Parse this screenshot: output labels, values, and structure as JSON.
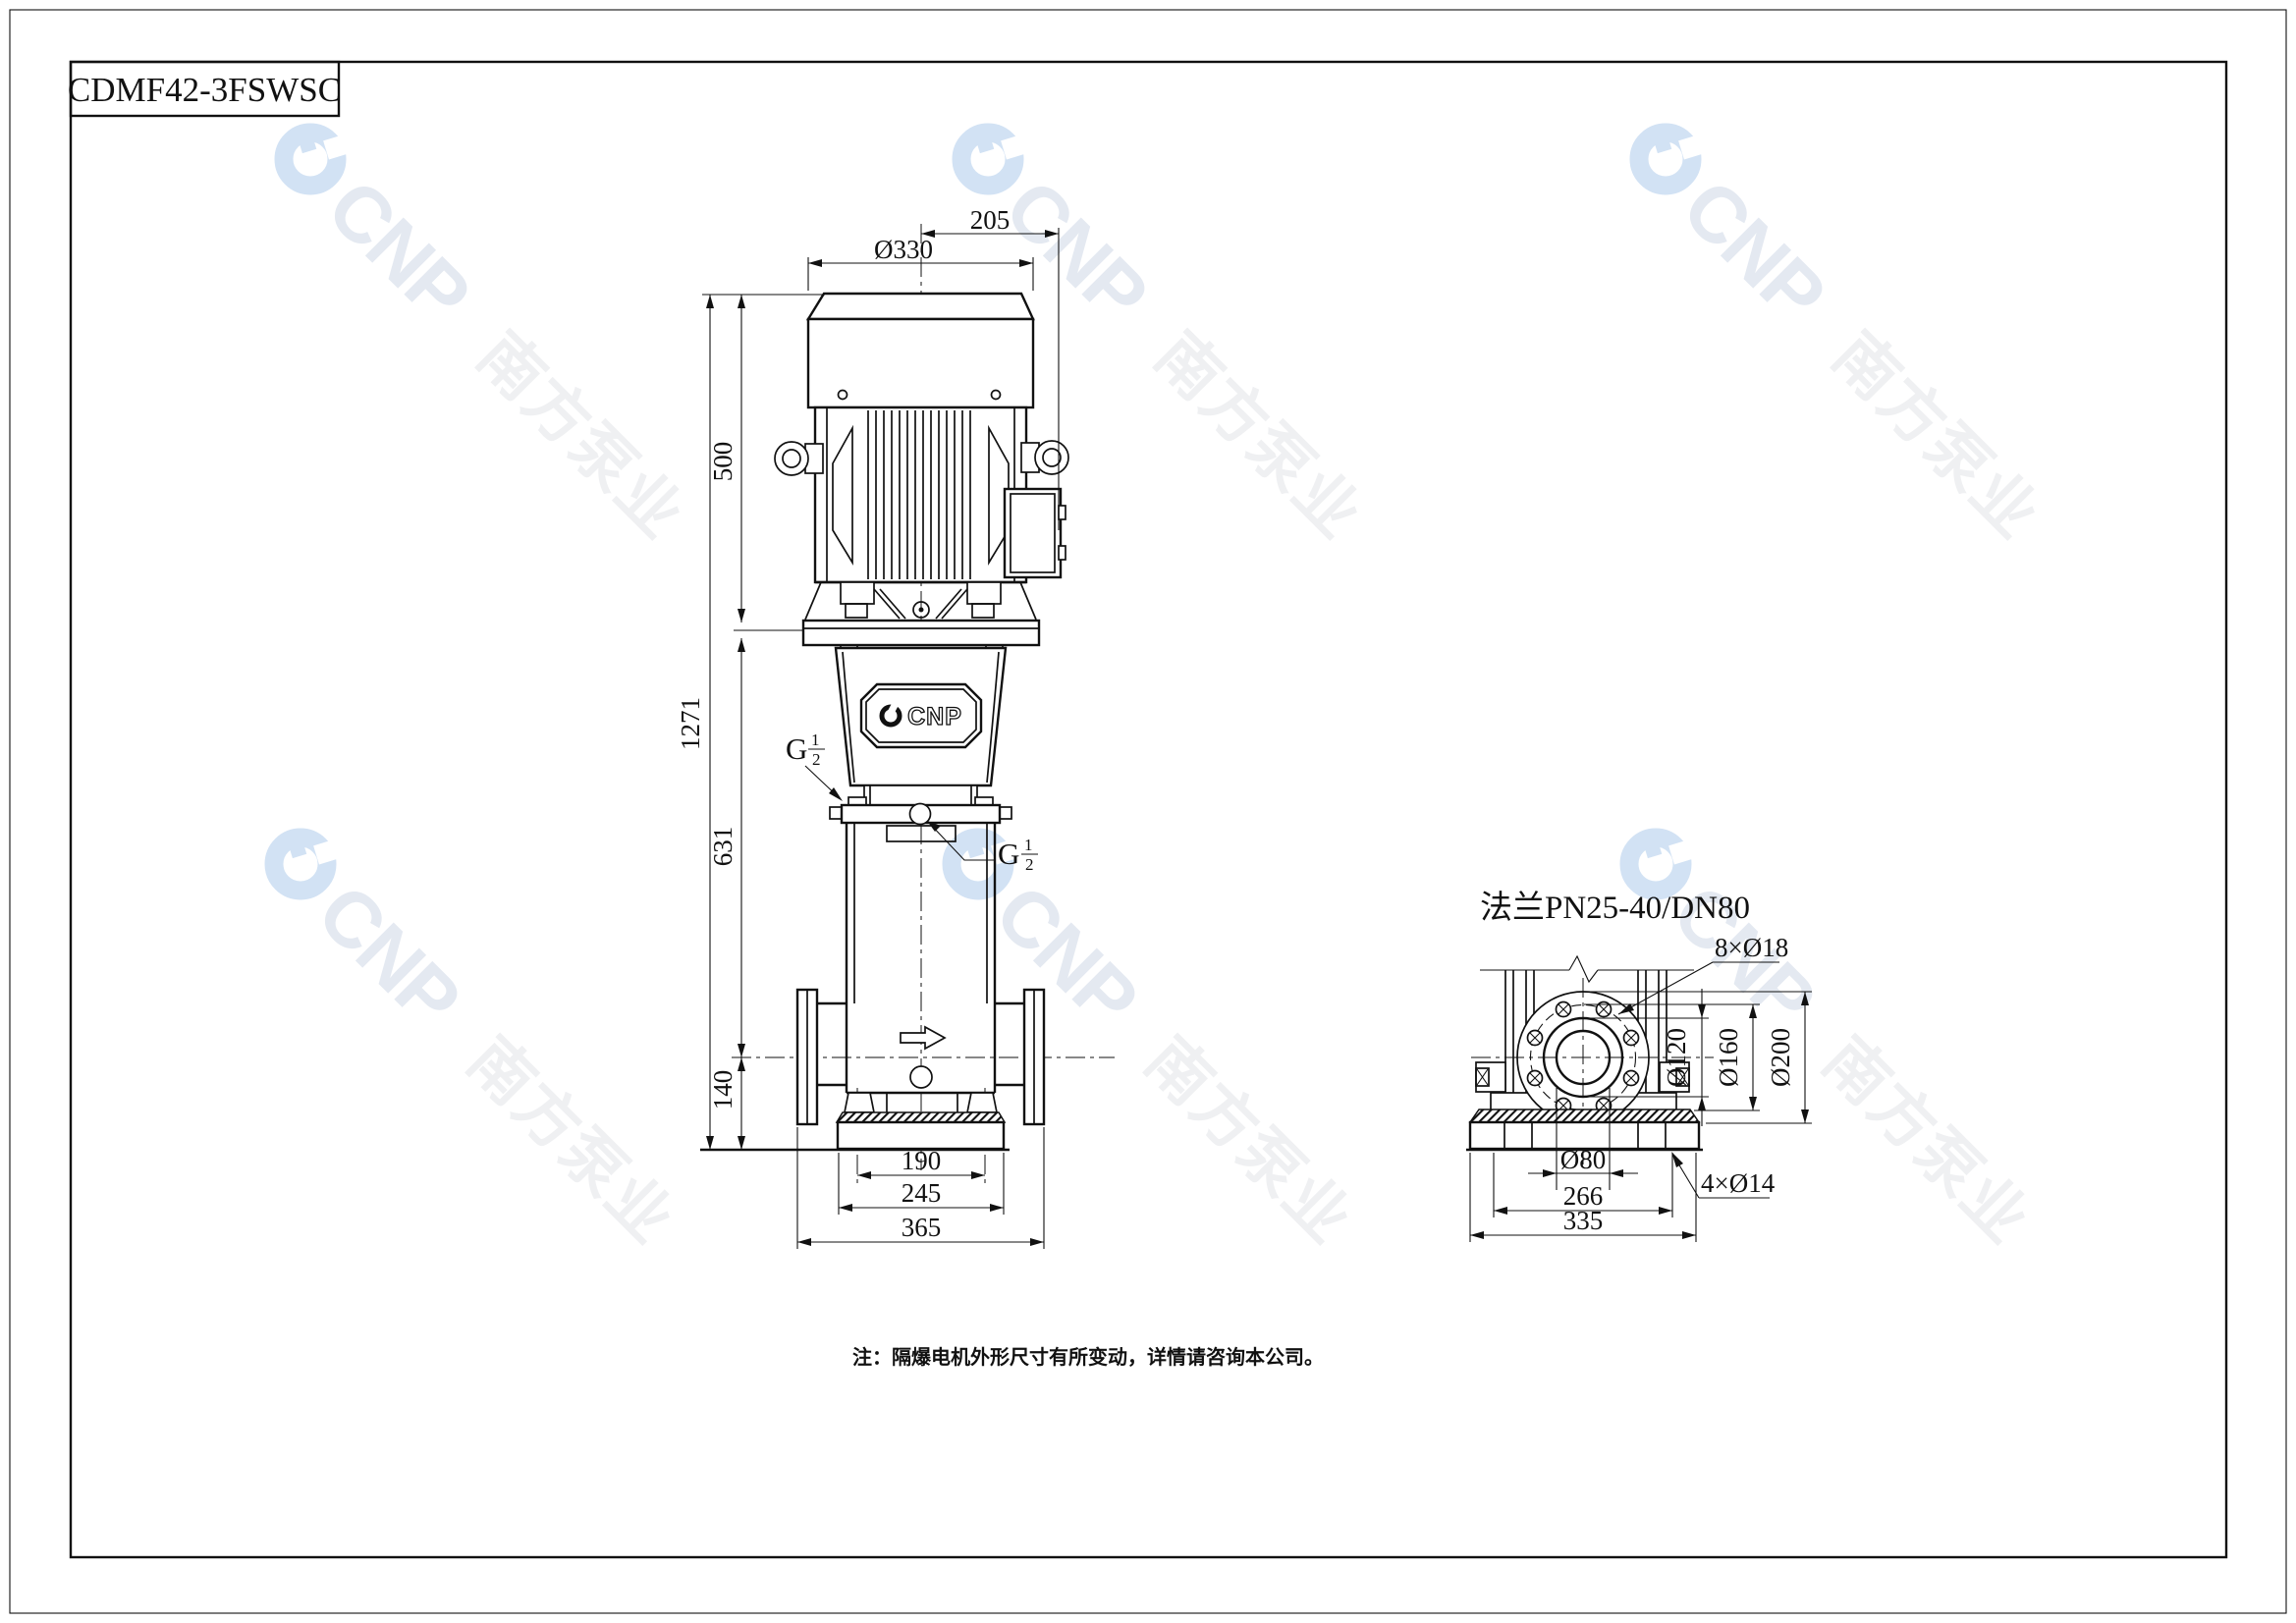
{
  "sheet": {
    "model": "CDMF42-3FSWSC",
    "note": "注：隔爆电机外形尺寸有所变动，详情请咨询本公司。"
  },
  "watermark": {
    "brand": "CNP",
    "company": "南方泵业",
    "logo_color": "#d2e2f4",
    "brand_color": "#e4e9f1",
    "company_color": "#eff0f2"
  },
  "front_view": {
    "badge_brand": "CNP",
    "dims": {
      "motor_width": "Ø330",
      "center_to_jbox": "205",
      "motor_height": "500",
      "overall_height": "1271",
      "flange_to_axis": "631",
      "axis_to_base": "140",
      "bolt_span": "190",
      "base_width": "245",
      "flange_span": "365"
    },
    "ports": {
      "gauge": {
        "g": "G",
        "num": "1",
        "den": "2"
      },
      "plug": {
        "g": "G",
        "num": "1",
        "den": "2"
      }
    }
  },
  "side_view": {
    "flange_label": "法兰PN25-40/DN80",
    "dims": {
      "bolt_holes": "8×Ø18",
      "raised_face": "Ø120",
      "bolt_circle": "Ø160",
      "flange_od": "Ø200",
      "bore": "Ø80",
      "anchor_span": "266",
      "base_width": "335",
      "anchor_holes": "4×Ø14"
    }
  }
}
